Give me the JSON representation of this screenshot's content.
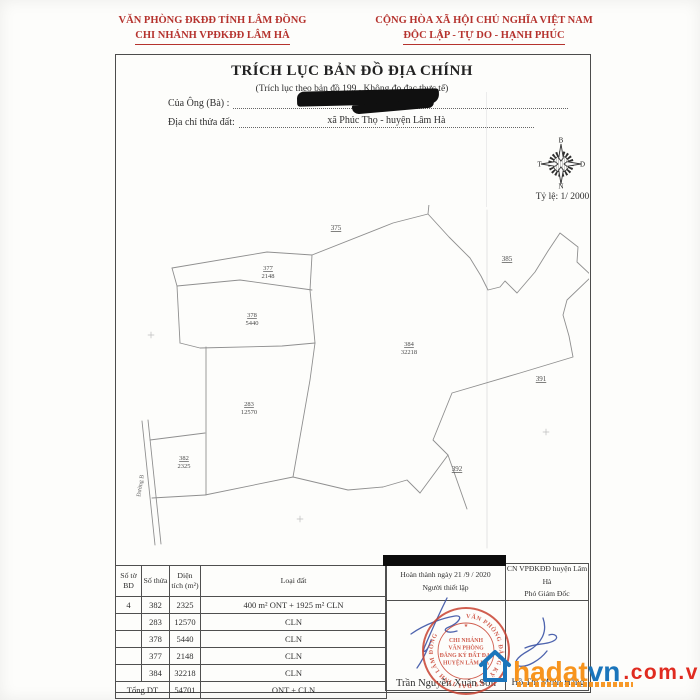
{
  "letterhead": {
    "left_line1": "VĂN PHÒNG ĐKĐĐ TỈNH LÂM ĐỒNG",
    "left_line2": "CHI NHÁNH VPĐKĐĐ LÂM HÀ",
    "right_line1": "CỘNG HÒA XÃ HỘI CHỦ NGHĨA VIỆT NAM",
    "right_line2": "ĐỘC LẬP - TỰ DO - HẠNH PHÚC"
  },
  "title": "TRÍCH LỤC BẢN ĐỒ ĐỊA CHÍNH",
  "subtitle": "(Trích lục theo bản đồ 199 . Không đo đạc thực tế)",
  "fields": {
    "owner_label": "Của Ông (Bà) :",
    "address_label": "Địa chỉ thửa đất:",
    "address_value": "xã Phúc Thọ  - huyện Lâm Hà"
  },
  "compass": {
    "north": "B",
    "south": "N",
    "west": "T",
    "east": "D",
    "scale_label": "Tỷ lệ: 1/ 2000"
  },
  "map": {
    "road_label": "Đường B",
    "parcels": [
      {
        "num": "377",
        "area": "2148",
        "x": 268,
        "y": 270
      },
      {
        "num": "378",
        "area": "5440",
        "x": 252,
        "y": 317
      },
      {
        "num": "384",
        "area": "32218",
        "x": 409,
        "y": 346
      },
      {
        "num": "283",
        "area": "12570",
        "x": 249,
        "y": 406
      },
      {
        "num": "382",
        "area": "2325",
        "x": 184,
        "y": 460
      }
    ],
    "neighbors": [
      {
        "num": "375",
        "x": 336,
        "y": 230
      },
      {
        "num": "385",
        "x": 507,
        "y": 261
      },
      {
        "num": "391",
        "x": 541,
        "y": 381
      },
      {
        "num": "392",
        "x": 457,
        "y": 471
      }
    ]
  },
  "table": {
    "headers": [
      "Số tờ BD",
      "Số thửa",
      "Diện tích (m²)",
      "Loại đất"
    ],
    "rows": [
      {
        "so_to": "4",
        "so_thua": "382",
        "dien_tich": "2325",
        "loai_dat": "400 m² ONT + 1925 m² CLN"
      },
      {
        "so_to": "",
        "so_thua": "283",
        "dien_tich": "12570",
        "loai_dat": "CLN"
      },
      {
        "so_to": "",
        "so_thua": "378",
        "dien_tich": "5440",
        "loai_dat": "CLN"
      },
      {
        "so_to": "",
        "so_thua": "377",
        "dien_tich": "2148",
        "loai_dat": "CLN"
      },
      {
        "so_to": "",
        "so_thua": "384",
        "dien_tich": "32218",
        "loai_dat": "CLN"
      }
    ],
    "total_label": "Tổng DT",
    "total_area": "54701",
    "total_type": "ONT + CLN"
  },
  "signoff": {
    "left_line1": "Hoàn thành ngày 21 /9 / 2020",
    "left_line2": "Người thiết lập",
    "right_line1": "CN VPĐKĐĐ huyện Lâm Hà",
    "right_line2": "Phó Giám Đốc",
    "left_name": "Trần Nguyễn Xuân Sơn",
    "right_name": "Hồ Thị Minh Hằng"
  },
  "stamp": {
    "ring": "VĂN PHÒNG ĐĂNG KÝ ĐẤT ĐAI TỈNH LÂM ĐỒNG",
    "line1": "CHI NHÁNH",
    "line2": "VĂN PHÒNG",
    "line3": "ĐĂNG KÝ ĐẤT ĐAI",
    "line4": "HUYỆN LÂM HÀ"
  },
  "watermark": {
    "text_main": "hadat",
    "text_vn": "vn",
    "text_domain": ".com.vn"
  },
  "colors": {
    "letterhead_red": "#b5332e",
    "stamp_red": "#c8402f",
    "signature_blue": "#3b53a5",
    "map_line_gray": "#8f8f8f",
    "wm_orange": "#f7941d",
    "wm_blue": "#1b75bb",
    "wm_red": "#e02b20"
  }
}
